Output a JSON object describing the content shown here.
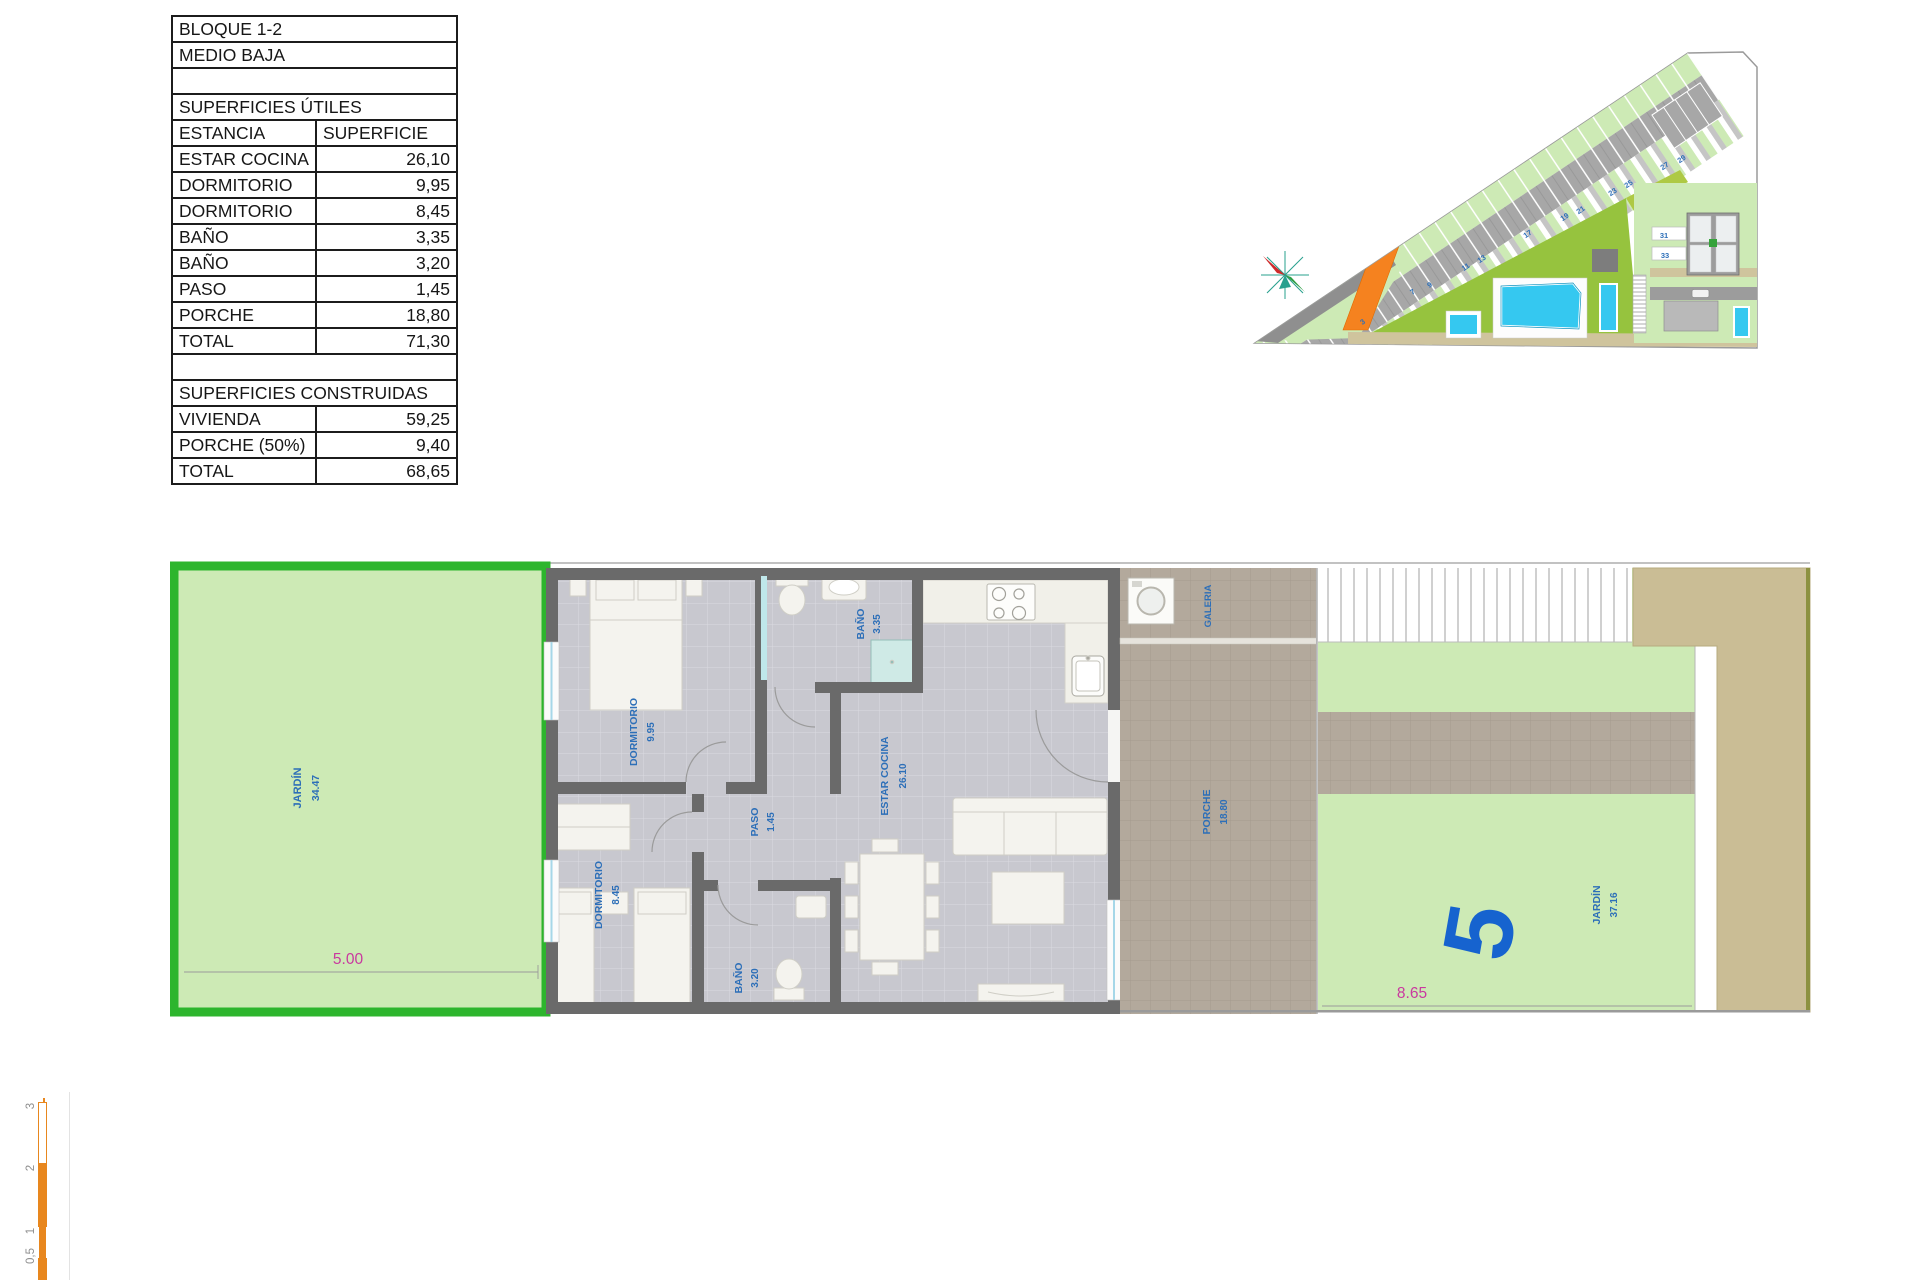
{
  "info_table": {
    "rows": [
      {
        "label": "BLOQUE 1-2",
        "value": null
      },
      {
        "label": "MEDIO BAJA",
        "value": null
      },
      {
        "label": "",
        "value": null
      },
      {
        "label": "SUPERFICIES ÚTILES",
        "value": null
      },
      {
        "label": "ESTANCIA",
        "value": "SUPERFICIE"
      },
      {
        "label": "ESTAR COCINA",
        "value": "26,10"
      },
      {
        "label": "DORMITORIO",
        "value": "9,95"
      },
      {
        "label": "DORMITORIO",
        "value": "8,45"
      },
      {
        "label": "BAÑO",
        "value": "3,35"
      },
      {
        "label": "BAÑO",
        "value": "3,20"
      },
      {
        "label": "PASO",
        "value": "1,45"
      },
      {
        "label": "PORCHE",
        "value": "18,80"
      },
      {
        "label": "TOTAL",
        "value": "71,30"
      },
      {
        "label": "",
        "value": null
      },
      {
        "label": "SUPERFICIES CONSTRUIDAS",
        "value": null
      },
      {
        "label": "VIVIENDA",
        "value": "59,25"
      },
      {
        "label": "PORCHE (50%)",
        "value": "9,40"
      },
      {
        "label": "TOTAL",
        "value": "68,65"
      }
    ]
  },
  "floor_plan": {
    "jardin_left": {
      "name": "JARDÍN",
      "area": "34.47",
      "dim": "5.00"
    },
    "dormitorio_1": {
      "name": "DORMITORIO",
      "area": "9.95"
    },
    "dormitorio_2": {
      "name": "DORMITORIO",
      "area": "8.45"
    },
    "bano_1": {
      "name": "BAÑO",
      "area": "3.35"
    },
    "bano_2": {
      "name": "BAÑO",
      "area": "3.20"
    },
    "paso": {
      "name": "PASO",
      "area": "1.45"
    },
    "estar_cocina": {
      "name": "ESTAR COCINA",
      "area": "26.10"
    },
    "galeria": {
      "name": "GALERIA"
    },
    "porche": {
      "name": "PORCHE",
      "area": "18.80"
    },
    "jardin_right": {
      "name": "JARDÍN",
      "area": "37.16",
      "dim": "8.65"
    },
    "plot_number": "5"
  },
  "site_plan": {
    "plot_labels": [
      "3",
      "7",
      "9",
      "11",
      "13",
      "17",
      "19",
      "21",
      "23",
      "25",
      "27",
      "29",
      "31",
      "33"
    ]
  },
  "scale_bar": {
    "labels": [
      "3",
      "2",
      "1",
      "0,5"
    ]
  },
  "colors": {
    "table_border": "#1c1c1c",
    "garden_fill": "#cdeab5",
    "garden_border": "#2db52d",
    "label_blue": "#2d6fb8",
    "dim_magenta": "#c9399f",
    "wall_gray": "#6a6a6a",
    "porch_tan": "#b3a99c",
    "beige_sidewalk": "#cabd95",
    "highlight_orange": "#f5821f",
    "pool_cyan": "#35c8f0",
    "lawn_green": "#96c33e",
    "scale_orange": "#e8871e"
  }
}
